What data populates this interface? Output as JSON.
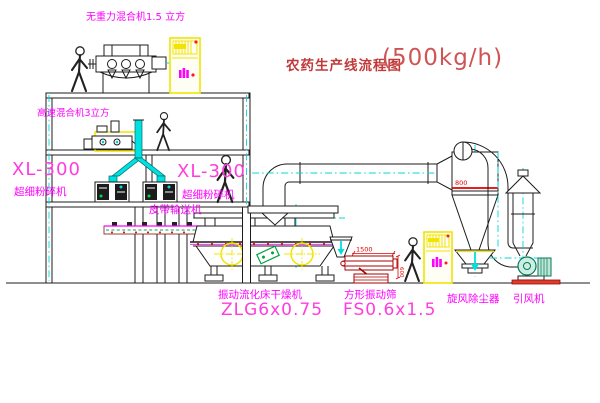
{
  "drawing": {
    "title_zh": "农药生产线流程图",
    "title_capacity": "(500kg/h)"
  },
  "labels": {
    "gravity_mixer": "无重力混合机1.5 立方",
    "high_speed_mixer": "高速混合机3立方",
    "mill_left_model": "XL-300",
    "mill_left_name": "超细粉碎机",
    "mill_center_model": "XL-300",
    "mill_center_name": "超细粉碎机",
    "belt_conveyor": "皮带输送机",
    "fluid_bed_dryer_name": "振动流化床干燥机",
    "fluid_bed_dryer_model": "ZLG6x0.75",
    "square_sieve_name": "方形振动筛",
    "square_sieve_model": "FS0.6x1.5",
    "cyclone_dust_collector": "旋风除尘器",
    "induced_draft_fan": "引风机"
  },
  "dimensions": {
    "sieve_length": "1500",
    "cyclone_dia": "800",
    "sieve_height": "600"
  },
  "colors": {
    "line_black": "#1c1c1c",
    "centerline_cyan": "#00d8d8",
    "duct_fill_cyan": "#00e0e0",
    "label_magenta": "#ff00ff",
    "model_pink": "#ff3ddd",
    "title_red": "#c03a3a",
    "dimension_red": "#e00000",
    "cabinet_yellow": "#f2e400",
    "machine_green": "#00a33e",
    "sieve_dark_red": "#a80000"
  }
}
